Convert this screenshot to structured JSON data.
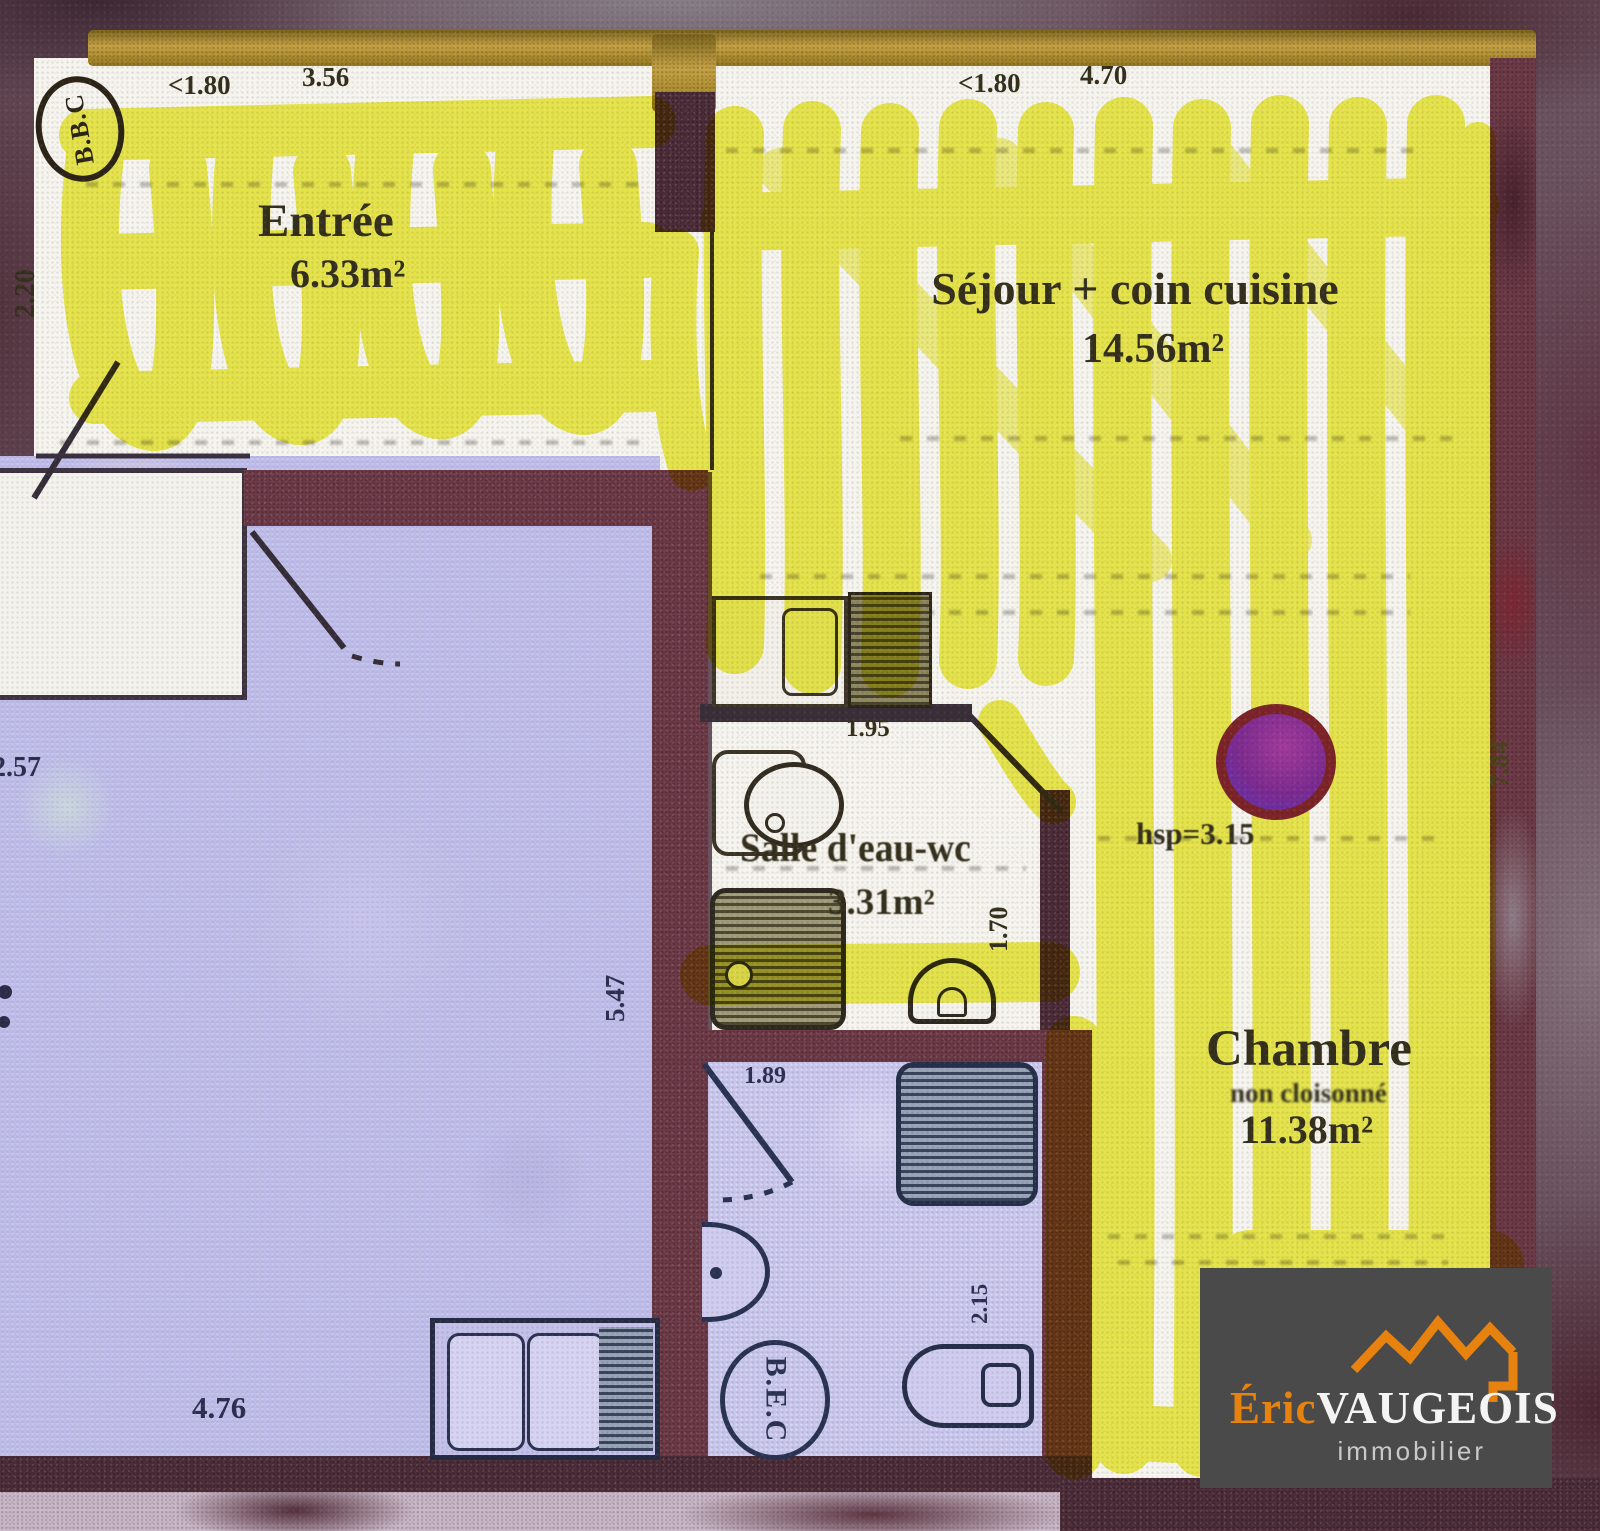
{
  "scan": {
    "description": "Scanned apartment floor plan with yellow highlighter over the subject lot"
  },
  "stamps": {
    "bbc": "B.B.C",
    "bec": "B.E.C"
  },
  "rooms": {
    "entree": {
      "label": "Entrée",
      "area": "6.33m²"
    },
    "sejour": {
      "label": "Séjour + coin cuisine",
      "area": "14.56m²"
    },
    "salle_eau": {
      "label": "Salle d'eau-wc",
      "area": "3.31m²"
    },
    "chambre": {
      "label": "Chambre",
      "note": "non cloisonné",
      "area": "11.38m²",
      "ceiling_height": "hsp=3.15"
    }
  },
  "dims": {
    "entree_door": "<1.80",
    "entree_width": "3.56",
    "entree_left": "2.20",
    "sejour_door": "<1.80",
    "sejour_width": "4.70",
    "salle_eau_width": "1.95",
    "salle_eau_depth": "1.70",
    "chambre_right": "7.84",
    "bath2_width": "1.89",
    "bath2_right": "2.15",
    "neighbor_left": "2.57",
    "neighbor_inner": "5.47",
    "neighbor_bottom": "4.76"
  },
  "logo": {
    "brand_first": "Éric",
    "brand_last": "VAUGEOIS",
    "tagline": "immobilier"
  },
  "colors": {
    "highlighter": "#ecec3a",
    "wall": "#6d3a47",
    "lavender": "#bcbae8",
    "gold": "#c5a245",
    "logo_bg": "#4a4a4a",
    "logo_orange": "#e8820e",
    "dot_ring": "#7c2428",
    "dot_fill": "#7d2b90"
  }
}
